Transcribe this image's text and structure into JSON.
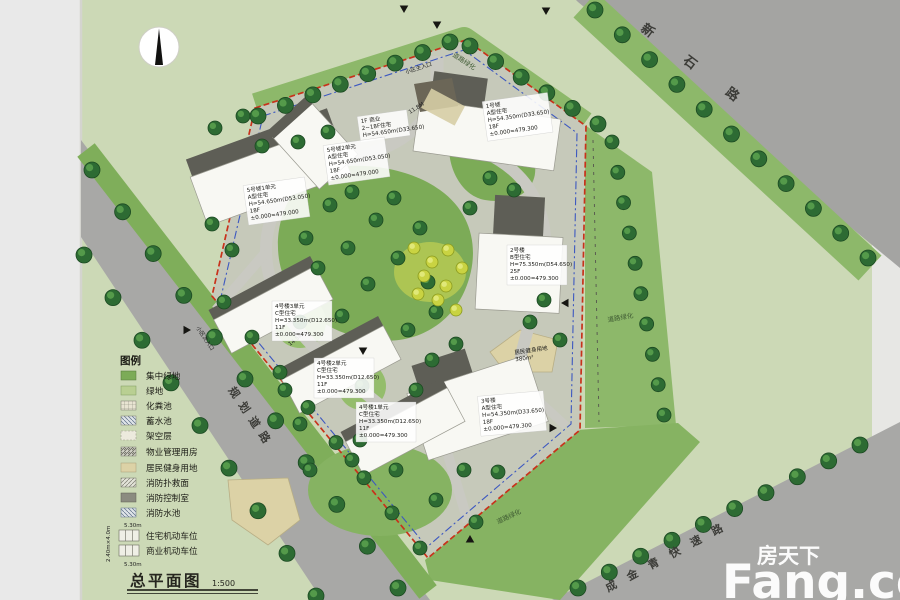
{
  "title_block": {
    "title": "总平面图",
    "scale": "1:500"
  },
  "compass": {
    "name": "north-arrow"
  },
  "roads": {
    "top_right": "新石路",
    "left": "规划道路",
    "bottom_right": "成金青快速路"
  },
  "green_belts": {
    "top": "道路绿化",
    "right": "道路绿化",
    "bottom": "道路绿化"
  },
  "entrances": {
    "main": "小区主入口",
    "secondary": "小区次入口"
  },
  "annotations": {
    "dim_top": "11.8M",
    "dim_mid": "14.5M"
  },
  "buildings": [
    {
      "id": "building-1",
      "lines": [
        "1号楼",
        "A型住宅",
        "H=54.350m(D33.650)",
        "18F",
        "±0.000=479.300"
      ]
    },
    {
      "id": "podium-shop",
      "lines": [
        "1F 商业",
        "2~18F住宅",
        "H=54.650m(D33.650)"
      ]
    },
    {
      "id": "building-5-unit-2",
      "lines": [
        "5号楼2单元",
        "A型住宅",
        "H=54.650m(D53.050)",
        "18F",
        "±0.000=479.000"
      ]
    },
    {
      "id": "building-5-unit-1",
      "lines": [
        "5号楼1单元",
        "A型住宅",
        "H=54.650m(D53.050)",
        "18F",
        "±0.000=479.000"
      ]
    },
    {
      "id": "building-2",
      "lines": [
        "2号楼",
        "B型住宅",
        "H=75.350m(D54.650)",
        "25F",
        "±0.000=479.300"
      ]
    },
    {
      "id": "building-3",
      "lines": [
        "3号楼",
        "A型住宅",
        "H=54.350m(D33.650)",
        "18F",
        "±0.000=479.300"
      ]
    },
    {
      "id": "building-4-unit-3",
      "lines": [
        "4号楼3单元",
        "C型住宅",
        "H=33.350m(D12.650)",
        "11F",
        "±0.000=479.300"
      ]
    },
    {
      "id": "building-4-unit-2",
      "lines": [
        "4号楼2单元",
        "C型住宅",
        "H=33.350m(D12.650)",
        "11F",
        "±0.000=479.300"
      ]
    },
    {
      "id": "building-4-unit-1",
      "lines": [
        "4号楼1单元",
        "C型住宅",
        "H=33.350m(D12.650)",
        "11F",
        "±0.000=479.300"
      ]
    }
  ],
  "site_features": {
    "fitness_area": {
      "line1": "居民健身用地",
      "line2": "380m²"
    }
  },
  "legend": {
    "title": "图例",
    "items": [
      {
        "label": "集中绿地"
      },
      {
        "label": "绿地"
      },
      {
        "label": "化粪池"
      },
      {
        "label": "蓄水池"
      },
      {
        "label": "架空层"
      },
      {
        "label": "物业管理用房"
      },
      {
        "label": "居民健身用地"
      },
      {
        "label": "消防扑救面"
      },
      {
        "label": "消防控制室"
      },
      {
        "label": "消防水池"
      },
      {
        "label": "住宅机动车位"
      },
      {
        "label": "商业机动车位"
      }
    ],
    "parking_depth_top": "5.30m",
    "parking_depth_bottom": "5.30m",
    "stall_size": "2.40m×4.0m"
  },
  "watermark": {
    "cn": "房天下",
    "en": "Fang.com"
  },
  "colors": {
    "page_green": "#ccd9b6",
    "road_gray": "#a7a7a5",
    "belt_green": "#8db86a",
    "park_green": "#7cab57",
    "tree_green": "#2d6b33",
    "boundary_red": "#c8321b",
    "boundary_blue": "#3d58c0",
    "beige": "#dcd2a6"
  }
}
